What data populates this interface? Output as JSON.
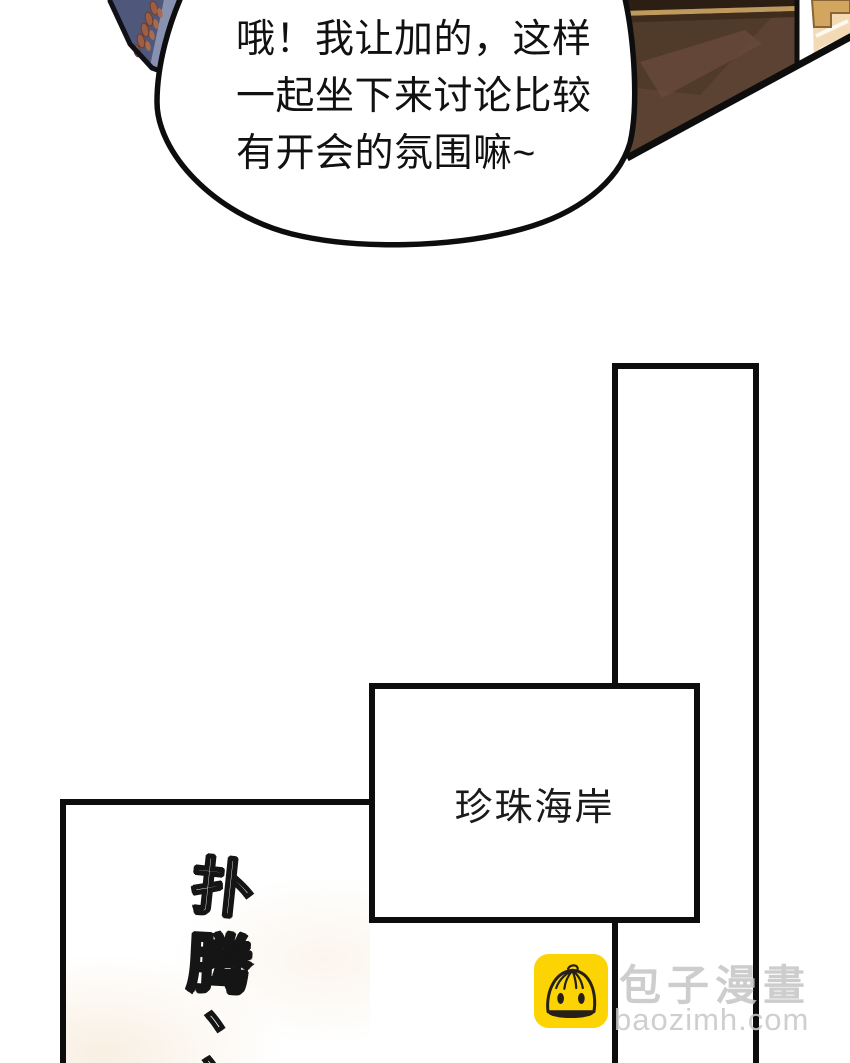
{
  "speech_bubble": {
    "text": "哦！我让加的，这样\n一起坐下来讨论比较\n有开会的氛围嘛~"
  },
  "location_box": {
    "label": "珍珠海岸"
  },
  "sfx": {
    "chars": [
      "扑",
      "腾",
      "、",
      "、"
    ]
  },
  "watermark": {
    "site_name": "包子漫畫",
    "site_url": "baozimh.com",
    "icon": "baozi-bun-icon",
    "icon_bg_color": "#fcd303",
    "text_color": "#c8c8c8"
  },
  "art_colors": {
    "outline": "#0d0d0d",
    "table_brown": "#5b4232",
    "table_top_strip": "#2c1e13",
    "table_gold_trim": "#bf9a5e",
    "sleeve_navy": "#4f587a",
    "sleeve_slate": "#8991b1",
    "sleeve_pale": "#c3c9dc",
    "sleeve_cream": "#f1eee3",
    "sleeve_gold": "#bd9440",
    "sleeve_rust_leaves": "#9c5f45",
    "corner_tan": "#f3dab4",
    "panel_tint": "#f4e6d2"
  }
}
